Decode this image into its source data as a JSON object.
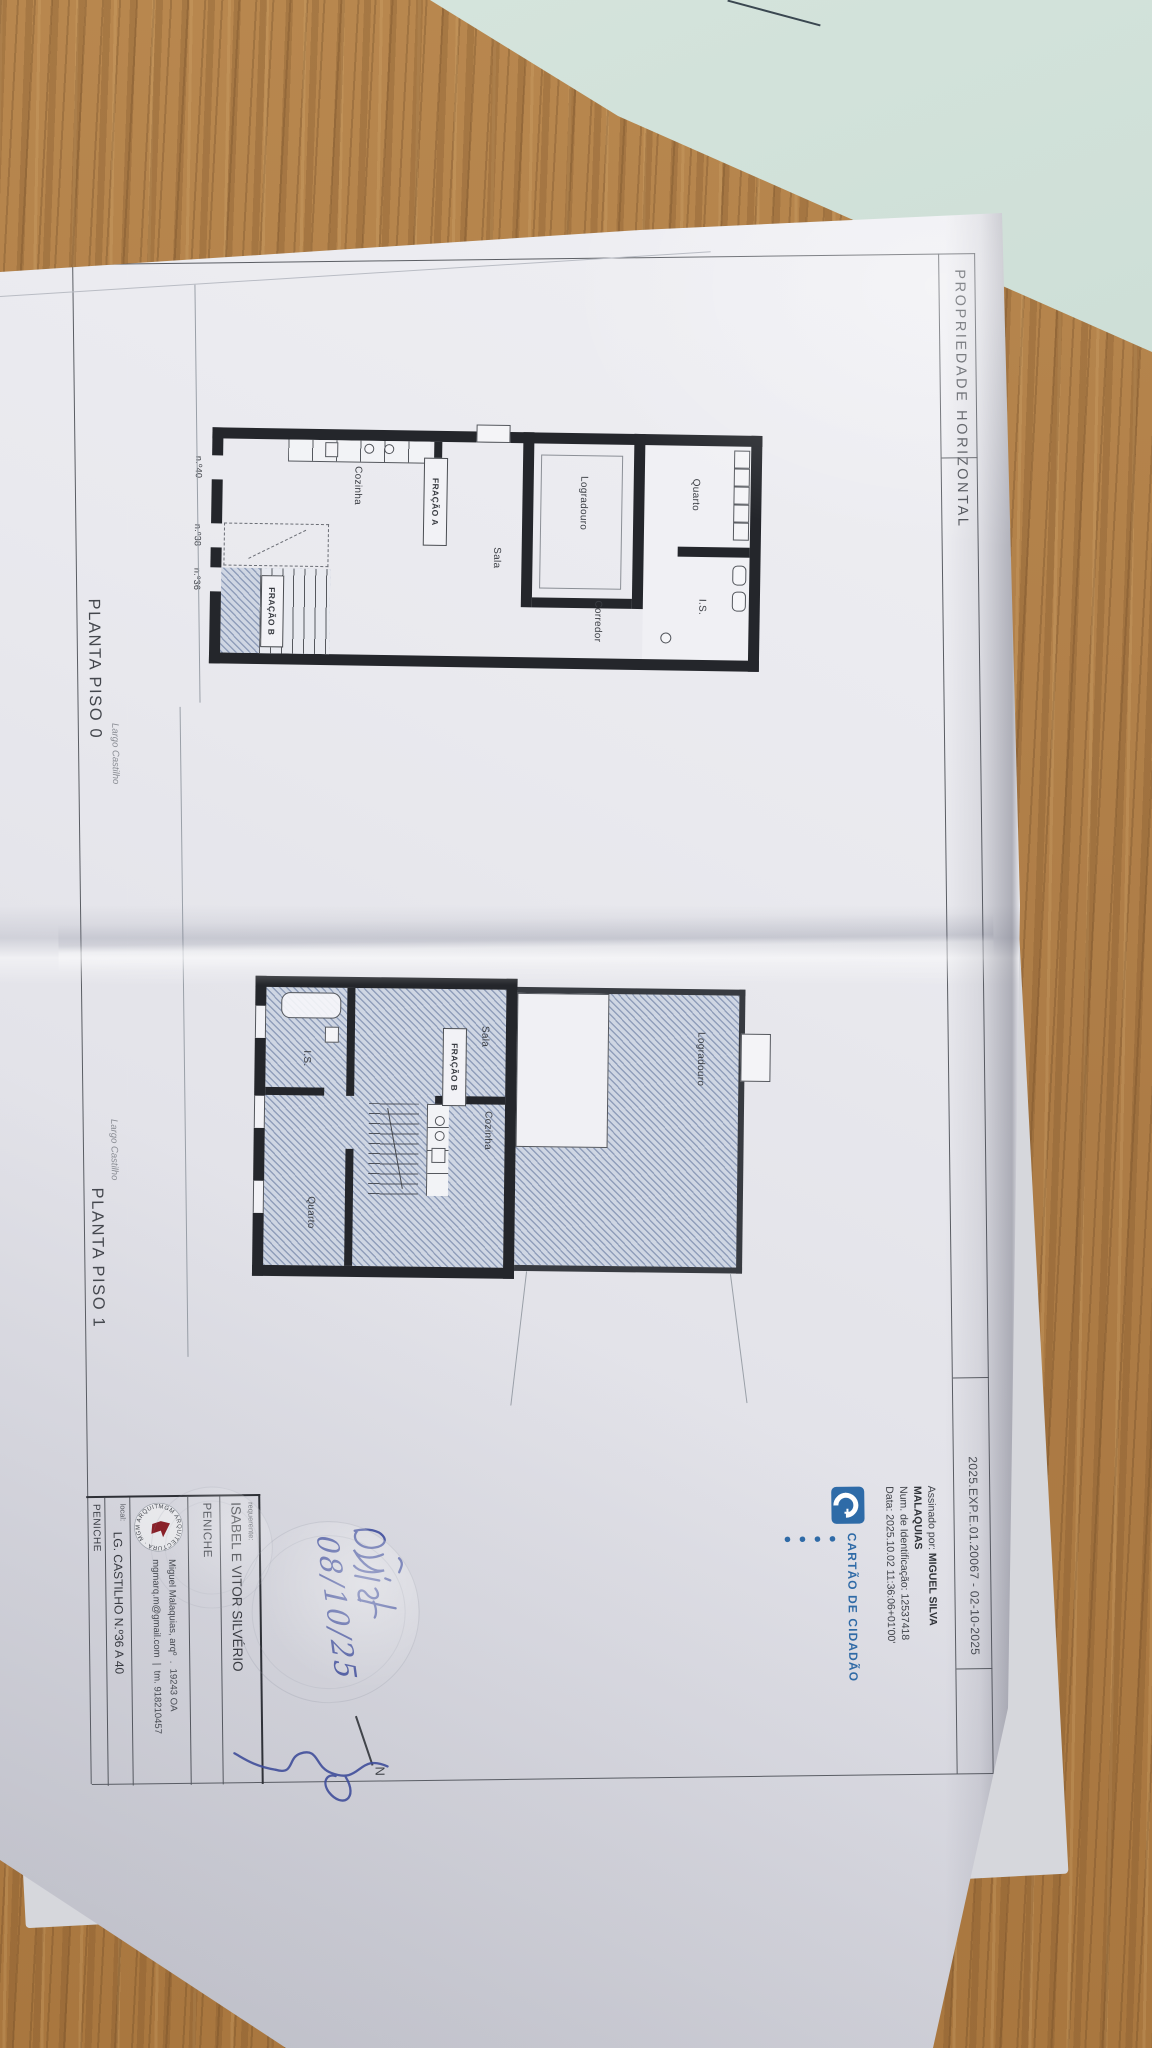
{
  "scene": {
    "surface": "wooden table",
    "wood_color": "#b28048",
    "teal_sheet_color": "#cddcd4",
    "paper_color": "#e9e9ee",
    "ink_color": "#3e4da0",
    "accent_blue": "#2e6ba8",
    "logo_red": "#8e1b22"
  },
  "doc": {
    "header": {
      "title": "PROPRIEDADE HORIZONTAL",
      "reference": "2025.EXP.E.01.20067 - 02-10-2025"
    },
    "signature_stamp": {
      "prefix": "Assinado por: ",
      "name_line1": "MIGUEL SILVA",
      "name_line2": "MALAQUIAS",
      "id_line": "Num. de Identificação: 12537418",
      "date_line": "Data: 2025.10.02 11:36:06+01'00'",
      "brand": "CARTÃO DE CIDADÃO",
      "dots": "● ● ● ●"
    },
    "piso0": {
      "caption": "PLANTA PISO 0",
      "street": "Largo Castilho",
      "quarto": "Quarto",
      "is": "I.S.",
      "corredor": "Corredor",
      "logradouro": "Logradouro",
      "sala": "Sala",
      "cozinha": "Cozinha",
      "fracao_a": "FRAÇÃO A",
      "fracao_b": "FRAÇÃO B",
      "n40": "n.º40",
      "n38": "n.º38",
      "n36": "n.º36"
    },
    "piso1": {
      "caption": "PLANTA PISO 1",
      "street": "Largo Castilho",
      "logradouro": "Logradouro",
      "sala": "Sala",
      "cozinha": "Cozinha",
      "quarto": "Quarto",
      "is": "I.S.",
      "fracao_b": "FRAÇÃO B"
    },
    "title_block": {
      "requerente_label": "requerente:",
      "requerente": "ISABEL E VITOR SILVÉRIO",
      "requerente_city": "PENICHE",
      "logo_ring": "MGM ARQUITECTURA · MGM ARQUITECTURA ·",
      "architect": "Miguel Malaquias, arqº",
      "sep_dot": ".",
      "oa_number": "19243 OA",
      "email": "mgmarq.m@gmail.com",
      "sep_bar": "|",
      "phone": "tm. 918210457",
      "local_label": "local:",
      "local": "LG. CASTILHO N.º36 A 40",
      "local_city": "PENICHE"
    },
    "annotations": {
      "north": "N",
      "handwritten_date": "08/10/25"
    }
  }
}
